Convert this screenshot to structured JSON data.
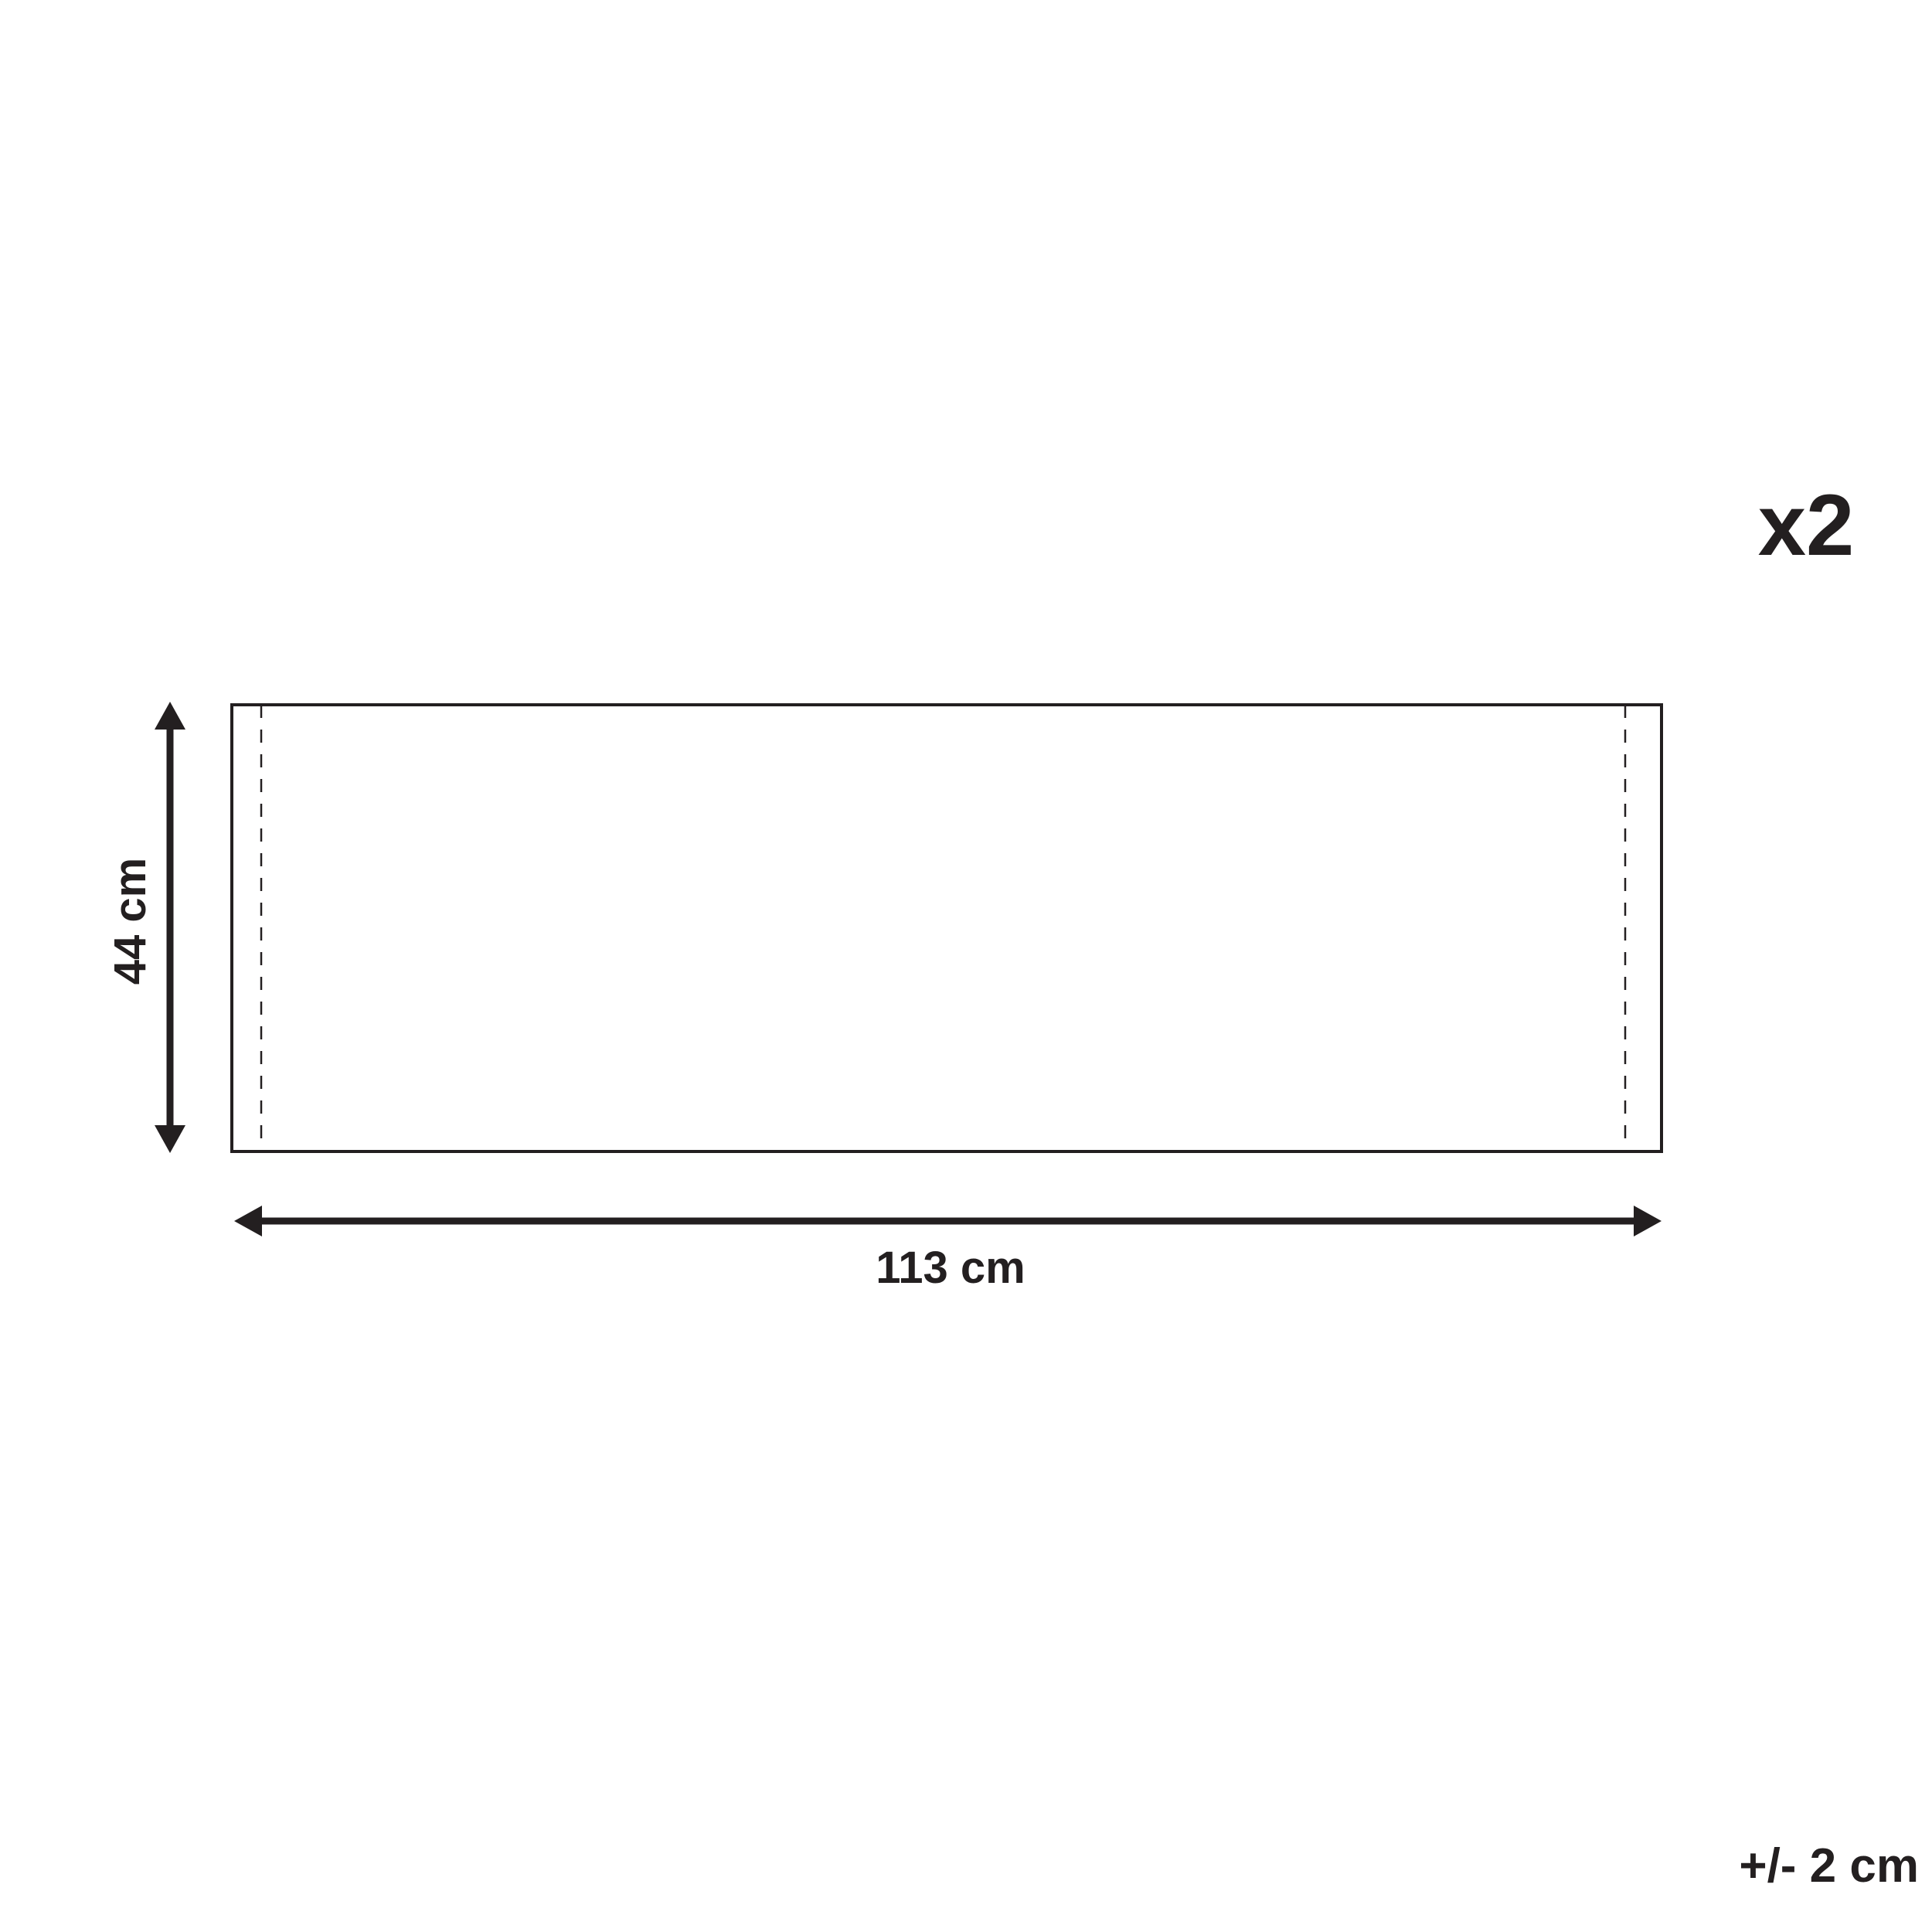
{
  "diagram": {
    "quantity_label": "x2",
    "width_label": "113 cm",
    "height_label": "44 cm",
    "tolerance_label": "+/- 2 cm",
    "dimensions": {
      "width_cm": 113,
      "height_cm": 44,
      "quantity": 2,
      "tolerance_cm": 2
    },
    "ink_color": "#231f20",
    "background_color": "#ffffff"
  }
}
